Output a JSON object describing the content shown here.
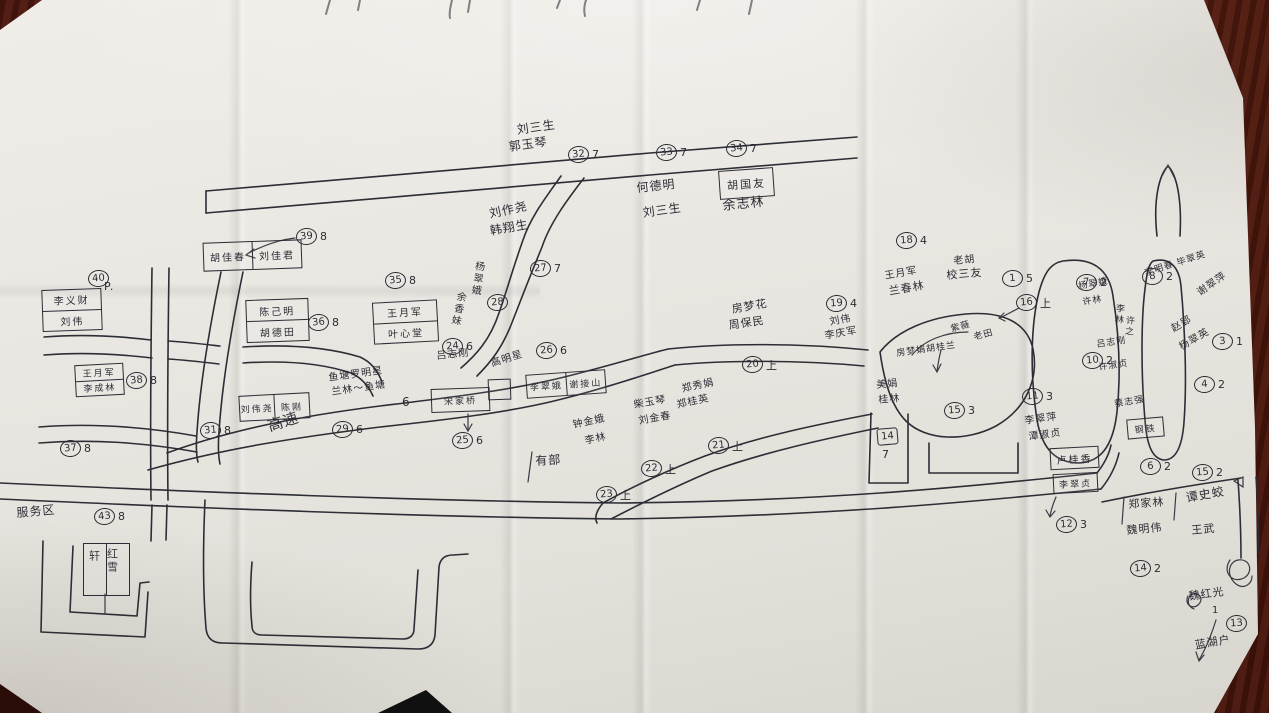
{
  "photo": {
    "surface": "dark red-brown wooden table",
    "paper_color": "#eae7e2",
    "ink_color": "#2d2d36",
    "table_color": "#5c2212"
  },
  "map": {
    "region_label": "服务区",
    "road_label": "高速",
    "labels": [
      {
        "t": "刘三生",
        "x": 516,
        "y": 124,
        "r": -8,
        "fs": 12
      },
      {
        "t": "郭玉琴",
        "x": 508,
        "y": 141,
        "r": -8,
        "fs": 12
      },
      {
        "t": "何德明",
        "x": 636,
        "y": 182,
        "r": -6,
        "fs": 12
      },
      {
        "t": "刘三生",
        "x": 642,
        "y": 207,
        "r": -8,
        "fs": 12
      },
      {
        "t": "余志林",
        "x": 722,
        "y": 200,
        "r": -6,
        "fs": 13
      },
      {
        "t": "刘作尧",
        "x": 488,
        "y": 208,
        "r": -12,
        "fs": 12
      },
      {
        "t": "韩翔生",
        "x": 489,
        "y": 225,
        "r": -10,
        "fs": 12
      },
      {
        "t": "杨翠娥",
        "x": 473,
        "y": 260,
        "v": 1,
        "r": 8,
        "fs": 10
      },
      {
        "t": "余香妹",
        "x": 455,
        "y": 290,
        "v": 1,
        "r": 12,
        "fs": 10
      },
      {
        "t": "吕志刚",
        "x": 436,
        "y": 352,
        "r": -6,
        "fs": 10
      },
      {
        "t": "高明星",
        "x": 490,
        "y": 360,
        "r": -18,
        "fs": 10
      },
      {
        "t": "鱼塘罗明星",
        "x": 328,
        "y": 374,
        "r": -8,
        "fs": 10
      },
      {
        "t": "兰林〜鱼塘",
        "x": 331,
        "y": 388,
        "r": -8,
        "fs": 10
      },
      {
        "t": "6",
        "x": 402,
        "y": 396,
        "r": 0,
        "fs": 12
      },
      {
        "t": "高速",
        "x": 266,
        "y": 420,
        "r": -18,
        "fs": 15
      },
      {
        "t": "有部",
        "x": 535,
        "y": 455,
        "r": -3,
        "fs": 12
      },
      {
        "t": "钟金娥",
        "x": 572,
        "y": 421,
        "r": -12,
        "fs": 10
      },
      {
        "t": "李林",
        "x": 584,
        "y": 437,
        "r": -12,
        "fs": 10
      },
      {
        "t": "柴玉琴",
        "x": 633,
        "y": 401,
        "r": -10,
        "fs": 10
      },
      {
        "t": "刘金春",
        "x": 638,
        "y": 417,
        "r": -10,
        "fs": 10
      },
      {
        "t": "郑秀娟",
        "x": 681,
        "y": 385,
        "r": -12,
        "fs": 10
      },
      {
        "t": "郑桂英",
        "x": 676,
        "y": 401,
        "r": -12,
        "fs": 10
      },
      {
        "t": "房梦花",
        "x": 731,
        "y": 304,
        "r": -10,
        "fs": 11
      },
      {
        "t": "周保民",
        "x": 728,
        "y": 320,
        "r": -8,
        "fs": 11
      },
      {
        "t": "王月军",
        "x": 884,
        "y": 272,
        "r": -10,
        "fs": 10
      },
      {
        "t": "兰春林",
        "x": 888,
        "y": 286,
        "r": -10,
        "fs": 11
      },
      {
        "t": "老胡",
        "x": 953,
        "y": 257,
        "r": -5,
        "fs": 10
      },
      {
        "t": "校三友",
        "x": 946,
        "y": 270,
        "r": -5,
        "fs": 11
      },
      {
        "t": "刘伟",
        "x": 829,
        "y": 318,
        "r": -10,
        "fs": 10
      },
      {
        "t": "李庆军",
        "x": 824,
        "y": 332,
        "r": -10,
        "fs": 10
      },
      {
        "t": "紫薇",
        "x": 950,
        "y": 326,
        "r": -15,
        "fs": 9
      },
      {
        "t": "老田",
        "x": 973,
        "y": 334,
        "r": -15,
        "fs": 9
      },
      {
        "t": "房梦娟胡桂兰",
        "x": 896,
        "y": 350,
        "r": -8,
        "fs": 9
      },
      {
        "t": "美娟",
        "x": 876,
        "y": 381,
        "r": -5,
        "fs": 10
      },
      {
        "t": "桂林",
        "x": 878,
        "y": 396,
        "r": -5,
        "fs": 10
      },
      {
        "t": "7",
        "x": 882,
        "y": 449,
        "r": 0,
        "fs": 11
      },
      {
        "t": "李翠萍",
        "x": 1024,
        "y": 417,
        "r": -8,
        "fs": 10
      },
      {
        "t": "潭淑贞",
        "x": 1028,
        "y": 433,
        "r": -8,
        "fs": 10
      },
      {
        "t": "杨翠娥",
        "x": 1078,
        "y": 283,
        "r": -10,
        "fs": 9
      },
      {
        "t": "许林",
        "x": 1082,
        "y": 299,
        "r": -10,
        "fs": 9
      },
      {
        "t": "李林",
        "x": 1114,
        "y": 303,
        "v": 1,
        "r": 5,
        "fs": 9
      },
      {
        "t": "许之",
        "x": 1124,
        "y": 315,
        "v": 1,
        "r": 5,
        "fs": 9
      },
      {
        "t": "吕志刚",
        "x": 1096,
        "y": 341,
        "r": -8,
        "fs": 9
      },
      {
        "t": "许淑贞",
        "x": 1098,
        "y": 364,
        "r": -8,
        "fs": 9
      },
      {
        "t": "蔡志强",
        "x": 1114,
        "y": 401,
        "r": -10,
        "fs": 9
      },
      {
        "t": "李明春",
        "x": 1144,
        "y": 270,
        "r": -18,
        "fs": 9
      },
      {
        "t": "毕翠英",
        "x": 1176,
        "y": 260,
        "r": -18,
        "fs": 9
      },
      {
        "t": "谢翠萍",
        "x": 1196,
        "y": 290,
        "r": -35,
        "fs": 10
      },
      {
        "t": "赵郢",
        "x": 1170,
        "y": 326,
        "r": -30,
        "fs": 10
      },
      {
        "t": "杨翠英",
        "x": 1178,
        "y": 344,
        "r": -30,
        "fs": 10
      },
      {
        "t": "郑家林",
        "x": 1128,
        "y": 499,
        "r": -4,
        "fs": 11
      },
      {
        "t": "魏明伟",
        "x": 1126,
        "y": 525,
        "r": -5,
        "fs": 11
      },
      {
        "t": "谭史蛟",
        "x": 1185,
        "y": 492,
        "r": -10,
        "fs": 12
      },
      {
        "t": "王武",
        "x": 1191,
        "y": 525,
        "r": -5,
        "fs": 11
      },
      {
        "t": "魏红光",
        "x": 1188,
        "y": 591,
        "r": -8,
        "fs": 11
      },
      {
        "t": "1",
        "x": 1212,
        "y": 606,
        "r": 0,
        "fs": 10
      },
      {
        "t": "蓝湖户",
        "x": 1194,
        "y": 640,
        "r": -10,
        "fs": 11
      },
      {
        "t": "服务区",
        "x": 16,
        "y": 507,
        "r": -5,
        "fs": 12
      },
      {
        "t": "P.",
        "x": 104,
        "y": 281,
        "r": 0,
        "fs": 11
      },
      {
        "t": "轩",
        "x": 88,
        "y": 550,
        "v": 1,
        "r": 0,
        "fs": 11
      },
      {
        "t": "红雪",
        "x": 106,
        "y": 548,
        "v": 1,
        "r": 0,
        "fs": 11
      }
    ],
    "boxes": [
      {
        "cells": [
          "李义财",
          "刘伟"
        ],
        "dir": "rows",
        "x": 42,
        "y": 289,
        "w": 58,
        "h": 40,
        "r": -2,
        "fs": 10
      },
      {
        "cells": [
          "王月军",
          "李成林"
        ],
        "dir": "rows",
        "x": 75,
        "y": 364,
        "w": 47,
        "h": 30,
        "r": -3,
        "fs": 9
      },
      {
        "cells": [
          "陈己明",
          "胡德田"
        ],
        "dir": "rows",
        "x": 246,
        "y": 299,
        "w": 61,
        "h": 41,
        "r": -2,
        "fs": 10
      },
      {
        "cells": [
          "王月军",
          "叶心堂"
        ],
        "dir": "rows",
        "x": 373,
        "y": 301,
        "w": 63,
        "h": 40,
        "r": -3,
        "fs": 10
      },
      {
        "cells": [
          "胡佳春",
          "刘佳君"
        ],
        "dir": "cols",
        "x": 203,
        "y": 241,
        "w": 97,
        "h": 27,
        "r": -2,
        "fs": 10
      },
      {
        "cells": [
          "刘伟尧",
          "陈刚"
        ],
        "dir": "cols",
        "x": 239,
        "y": 394,
        "w": 69,
        "h": 24,
        "r": -3,
        "fs": 9
      },
      {
        "cells": [
          "李翠娥",
          "谢接山"
        ],
        "dir": "cols",
        "x": 526,
        "y": 372,
        "w": 78,
        "h": 22,
        "r": -4,
        "fs": 9
      },
      {
        "cells": [
          "胡国友"
        ],
        "dir": "cols",
        "x": 719,
        "y": 169,
        "w": 53,
        "h": 27,
        "r": -4,
        "fs": 11
      },
      {
        "cells": [
          "宋家桥"
        ],
        "dir": "cols",
        "x": 431,
        "y": 388,
        "w": 57,
        "h": 22,
        "r": -2,
        "fs": 9
      },
      {
        "cells": [
          ""
        ],
        "dir": "cols",
        "x": 488,
        "y": 379,
        "w": 21,
        "h": 19,
        "r": -2,
        "fs": 9
      },
      {
        "cells": [
          "钢铁"
        ],
        "dir": "cols",
        "x": 1127,
        "y": 418,
        "w": 35,
        "h": 18,
        "r": -5,
        "fs": 9
      },
      {
        "cells": [
          "卢桂香"
        ],
        "dir": "cols",
        "x": 1050,
        "y": 447,
        "w": 47,
        "h": 20,
        "r": -3,
        "fs": 10
      },
      {
        "cells": [
          "李翠贞"
        ],
        "dir": "cols",
        "x": 1053,
        "y": 473,
        "w": 43,
        "h": 18,
        "r": -3,
        "fs": 9
      },
      {
        "cells": [
          "",
          ""
        ],
        "dir": "cols",
        "x": 83,
        "y": 543,
        "w": 45,
        "h": 51,
        "r": 0,
        "fs": 10
      }
    ],
    "markers": [
      {
        "n": "40",
        "s": "",
        "x": 88,
        "y": 270
      },
      {
        "n": "39",
        "s": "8",
        "x": 296,
        "y": 228
      },
      {
        "n": "35",
        "s": "8",
        "x": 385,
        "y": 272
      },
      {
        "n": "36",
        "s": "8",
        "x": 308,
        "y": 314
      },
      {
        "n": "38",
        "s": "8",
        "x": 126,
        "y": 372
      },
      {
        "n": "37",
        "s": "8",
        "x": 60,
        "y": 440
      },
      {
        "n": "31",
        "s": "8",
        "x": 200,
        "y": 422
      },
      {
        "n": "29",
        "s": "6",
        "x": 332,
        "y": 421
      },
      {
        "n": "24",
        "s": "6",
        "x": 442,
        "y": 338
      },
      {
        "n": "26",
        "s": "6",
        "x": 536,
        "y": 342
      },
      {
        "n": "25",
        "s": "6",
        "x": 452,
        "y": 432
      },
      {
        "n": "28",
        "s": "",
        "x": 487,
        "y": 294
      },
      {
        "n": "27",
        "s": "7",
        "x": 530,
        "y": 260
      },
      {
        "n": "32",
        "s": "7",
        "x": 568,
        "y": 146
      },
      {
        "n": "33",
        "s": "7",
        "x": 656,
        "y": 144
      },
      {
        "n": "34",
        "s": "7",
        "x": 726,
        "y": 140
      },
      {
        "n": "20",
        "s": "上",
        "x": 742,
        "y": 356
      },
      {
        "n": "21",
        "s": "上",
        "x": 708,
        "y": 437
      },
      {
        "n": "22",
        "s": "上",
        "x": 641,
        "y": 460
      },
      {
        "n": "23",
        "s": "上",
        "x": 596,
        "y": 486
      },
      {
        "n": "18",
        "s": "4",
        "x": 896,
        "y": 232
      },
      {
        "n": "19",
        "s": "4",
        "x": 826,
        "y": 295
      },
      {
        "n": "1",
        "s": "5",
        "x": 1002,
        "y": 270
      },
      {
        "n": "16",
        "s": "上",
        "x": 1016,
        "y": 294
      },
      {
        "n": "15",
        "s": "3",
        "x": 944,
        "y": 402
      },
      {
        "n": "14",
        "s": "",
        "x": 877,
        "y": 428,
        "boxed": true
      },
      {
        "n": "11",
        "s": "3",
        "x": 1022,
        "y": 388
      },
      {
        "n": "12",
        "s": "3",
        "x": 1056,
        "y": 516
      },
      {
        "n": "7",
        "s": "2",
        "x": 1076,
        "y": 274
      },
      {
        "n": "10",
        "s": "2",
        "x": 1082,
        "y": 352
      },
      {
        "n": "8",
        "s": "2",
        "x": 1142,
        "y": 268
      },
      {
        "n": "3",
        "s": "1",
        "x": 1212,
        "y": 333
      },
      {
        "n": "4",
        "s": "2",
        "x": 1194,
        "y": 376
      },
      {
        "n": "6",
        "s": "2",
        "x": 1140,
        "y": 458
      },
      {
        "n": "15",
        "s": "2",
        "x": 1192,
        "y": 464
      },
      {
        "n": "14",
        "s": "2",
        "x": 1130,
        "y": 560
      },
      {
        "n": "13",
        "s": "",
        "x": 1226,
        "y": 615
      },
      {
        "n": "43",
        "s": "8",
        "x": 94,
        "y": 508
      }
    ]
  }
}
